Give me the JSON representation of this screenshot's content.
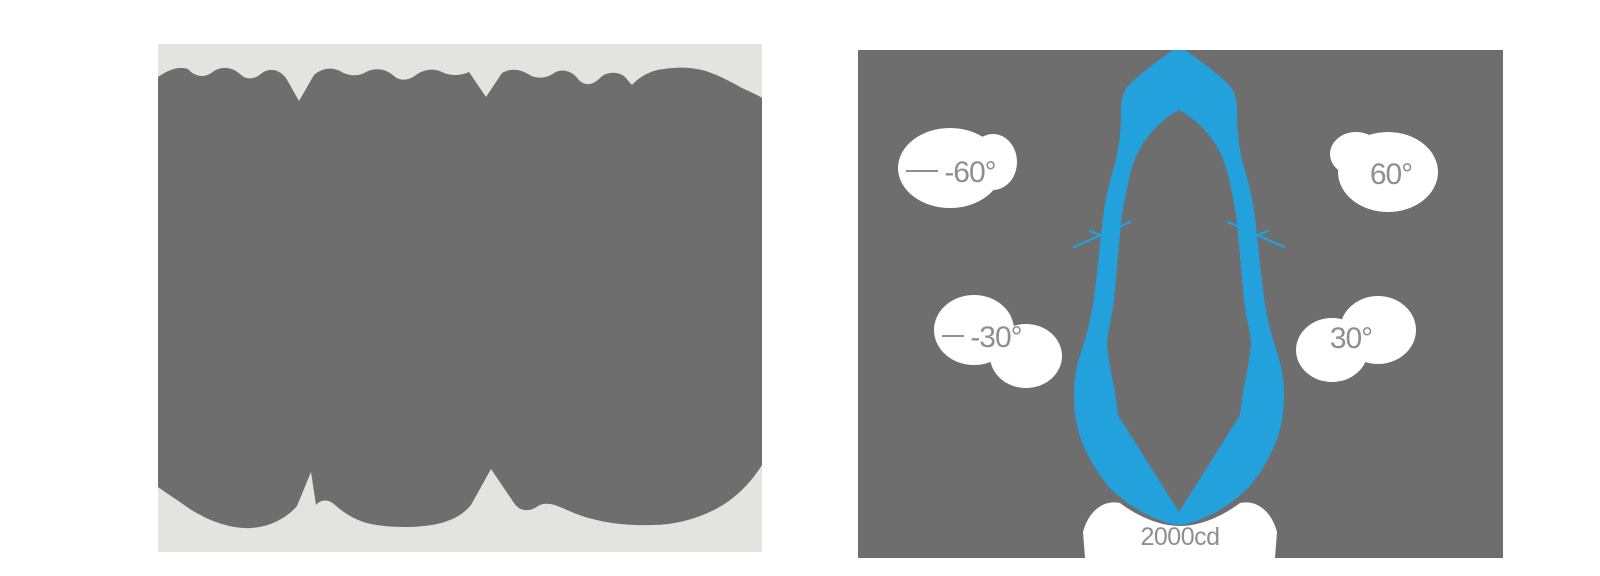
{
  "colors": {
    "page_background": "#ffffff",
    "left_panel_background": "#e3e4e1",
    "silhouette_gray": "#6e6e6e",
    "right_panel_background": "#6e6e6e",
    "beam_blue": "#22a1dd",
    "label_text_gray": "#8f8f8f",
    "label_halo": "#ffffff"
  },
  "right_panel": {
    "labels": {
      "minus60": "-60°",
      "plus60": "60°",
      "minus30": "-30°",
      "plus30": "30°",
      "max_candela": "2000cd"
    }
  },
  "chart_data": {
    "type": "line",
    "subtype": "polar-photometric-light-distribution",
    "title": "",
    "angle_tick_labels": [
      "-60°",
      "-30°",
      "30°",
      "60°"
    ],
    "angle_ticks_deg": [
      -60,
      -30,
      30,
      60
    ],
    "radial_outer_ring_label": "2000cd",
    "radial_unit": "cd",
    "ylim": [
      0,
      2000
    ],
    "grid": "angle tick crosses at ±15° on curve; angle labels on white halos",
    "legend_position": "none",
    "series": [
      {
        "name": "luminous intensity",
        "angles_deg": [
          -75,
          -60,
          -45,
          -30,
          -20,
          -15,
          -10,
          -5,
          0,
          5,
          10,
          15,
          20,
          30,
          45,
          60,
          75
        ],
        "intensity_cd": [
          300,
          390,
          640,
          1050,
          1650,
          1680,
          1700,
          1850,
          2000,
          1850,
          1700,
          1680,
          1650,
          1050,
          640,
          390,
          300
        ]
      }
    ]
  }
}
